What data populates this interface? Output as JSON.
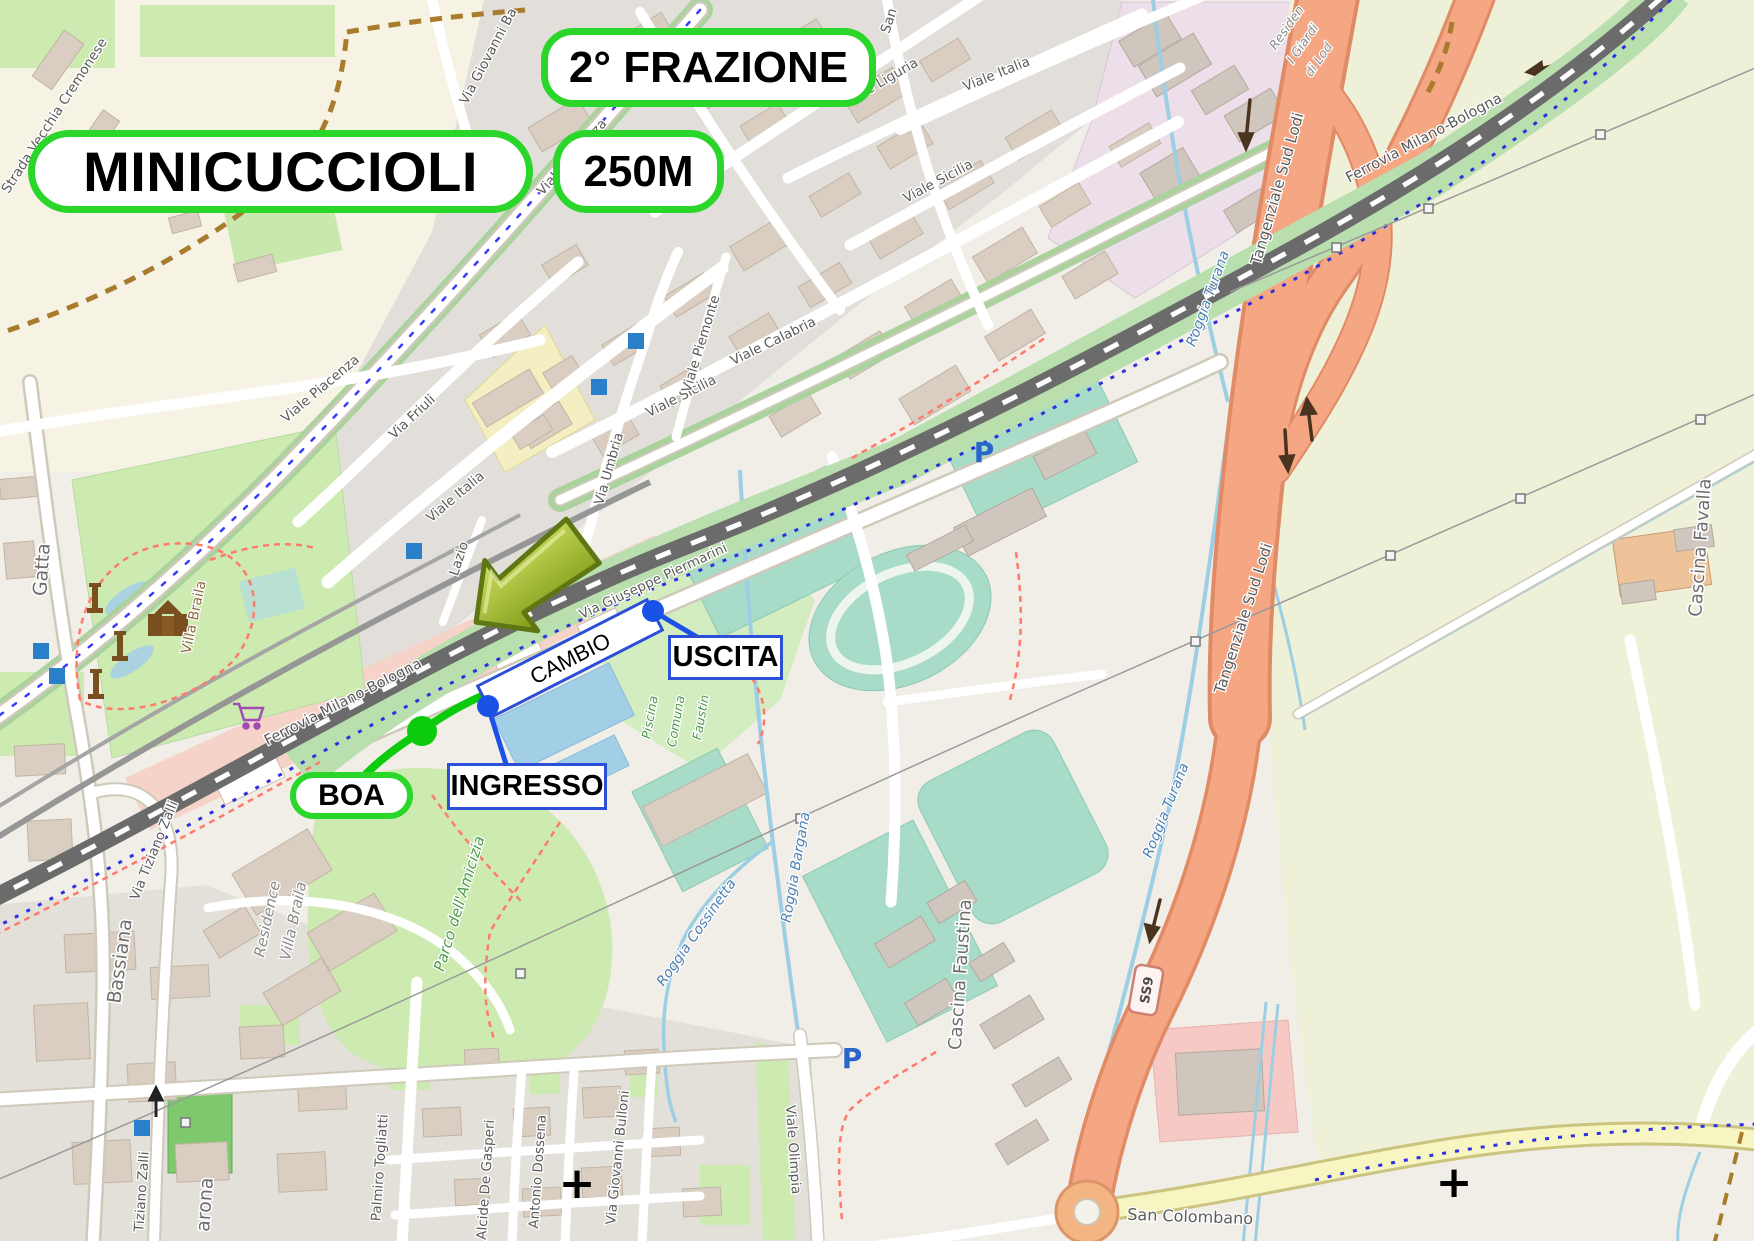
{
  "annotations": {
    "race_title": "MINICUCCIOLI",
    "fraction": "2° FRAZIONE",
    "distance": "250M",
    "boa": "BOA",
    "ingresso": "INGRESSO",
    "uscita": "USCITA",
    "cambio": "CAMBIO"
  },
  "streets": {
    "strada_vecchia_cremonese": "Strada Vecchia Cremonese",
    "via_giovanni_ba": "Via Giovanni Ba",
    "viale_piacenza": "Viale Piacenza",
    "via_friuli": "Via Friuli",
    "viale_italia": "Viale Italia",
    "viale_liguria": "Viale Liguria",
    "viale_sicilia": "Viale Sicilia",
    "viale_calabria": "Viale Calabria",
    "viale_piemonte": "Viale Piemonte",
    "via_umbria": "Via Umbria",
    "lazio": "Lazio",
    "san": "San",
    "gatta": "Gatta",
    "bassiana": "Bassiana",
    "via_tiziano_zalli": "Via Tiziano Zalli",
    "tiziano_zalli": "Tiziano Zalli",
    "varona": "arona",
    "palmiro_togliatti": "Palmiro Togliatti",
    "alcide_de_gasperi": "Alcide De Gasperi",
    "antonio_dossena": "Antonio Dossena",
    "via_giovanni_bulloni": "Via Giovanni Bulloni",
    "viale_olimpia": "Viale Olimpia",
    "via_giuseppe_piermarini": "Via Giuseppe Piermarini",
    "san_colombano": "San Colombano",
    "tangenziale_sud_lodi": "Tangenziale Sud Lodi",
    "ss9": "SS9"
  },
  "railway": {
    "ferrovia": "Ferrovia Milano-Bologna"
  },
  "water": {
    "roggia_turana": "Roggia Turana",
    "roggia_bargana": "Roggia Bargana",
    "roggia_cossinetta": "Roggia Cossinetta"
  },
  "places": {
    "villa_braila": "Villa Braila",
    "residence": "Residence",
    "residence_villa": "Villa Braila",
    "parco_amicizia": "Parco dell'Amicizia",
    "piscina_l1": "Piscina",
    "piscina_l2": "Comuna",
    "piscina_l3": "Faustin",
    "cascina_faustina": "Cascina Faustina",
    "cascina_favalla": "Cascina Favalla",
    "residen_l1": "Residen",
    "residen_l2": "I Giardi",
    "residen_l3": "di Lod"
  },
  "symbols": {
    "parking": "P",
    "level_crossing": "+"
  },
  "colors": {
    "route_green": "#0ccb0c",
    "marker_blue": "#1a52e8",
    "label_border_green": "#2bd62b",
    "label_border_blue": "#2b4fd7",
    "tangenziale_orange": "#f5a682",
    "railway_gray": "#6b6b6b",
    "pitch_teal": "#a8dcc8",
    "park_green": "#cdebb0",
    "water_blue": "#aad3df",
    "arrow_olive": "#9db32a"
  }
}
